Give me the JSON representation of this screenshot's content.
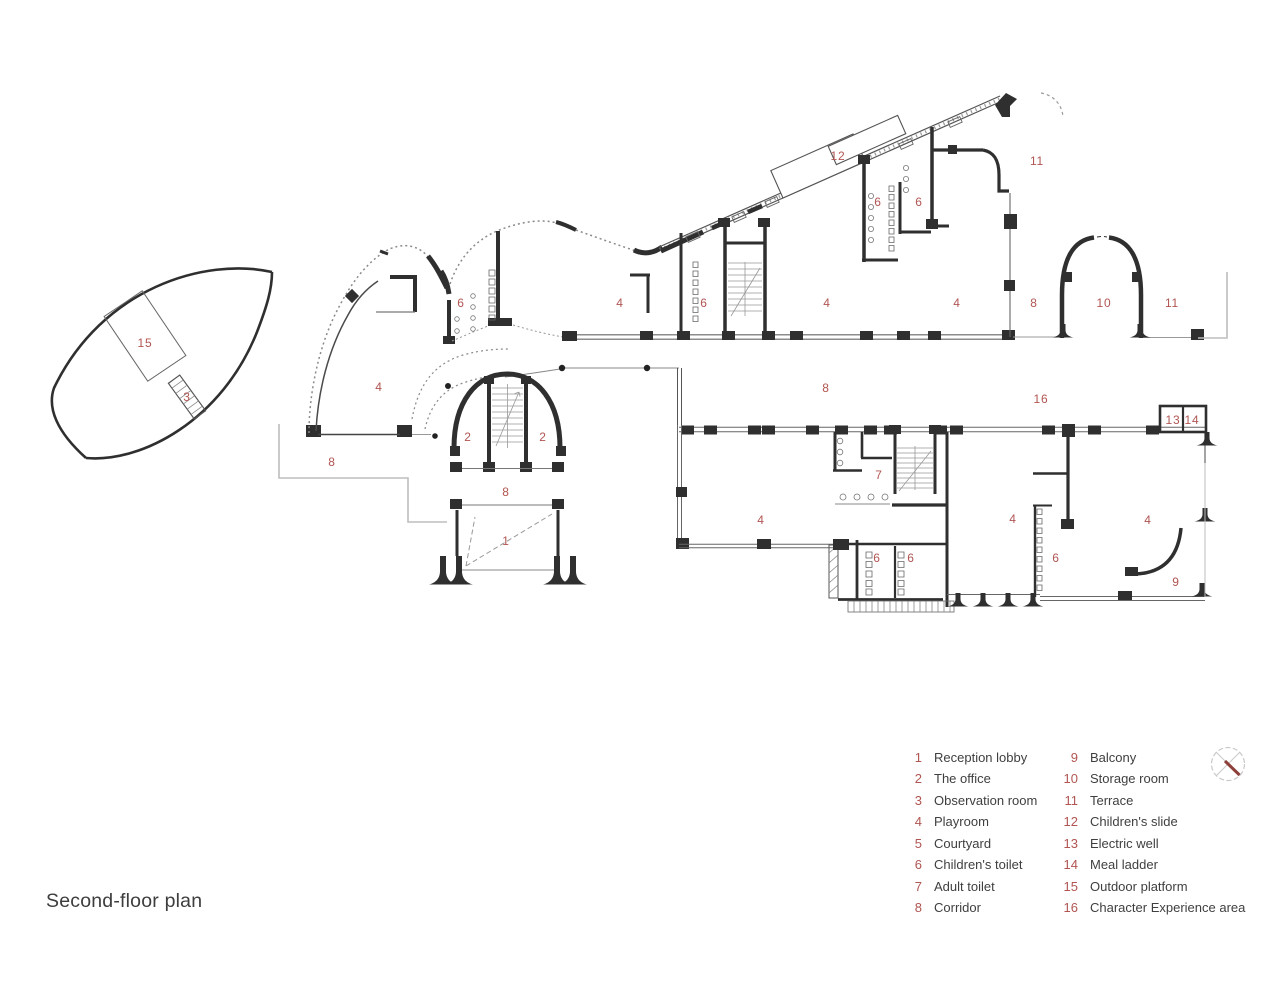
{
  "title": "Second-floor plan",
  "colors": {
    "red": "#b05552",
    "ink": "#2f2f2f",
    "gray": "#9a9a9a",
    "light": "#c9c9c9"
  },
  "compass": {
    "name": "north-compass"
  },
  "legend": {
    "items_left": [
      {
        "num": "1",
        "label": "Reception lobby"
      },
      {
        "num": "2",
        "label": "The office"
      },
      {
        "num": "3",
        "label": "Observation room"
      },
      {
        "num": "4",
        "label": "Playroom"
      },
      {
        "num": "5",
        "label": "Courtyard"
      },
      {
        "num": "6",
        "label": "Children's toilet"
      },
      {
        "num": "7",
        "label": "Adult toilet"
      },
      {
        "num": "8",
        "label": "Corridor"
      }
    ],
    "items_right": [
      {
        "num": "9",
        "label": "Balcony"
      },
      {
        "num": "10",
        "label": "Storage room"
      },
      {
        "num": "11",
        "label": "Terrace"
      },
      {
        "num": "12",
        "label": "Children's slide"
      },
      {
        "num": "13",
        "label": "Electric well"
      },
      {
        "num": "14",
        "label": "Meal ladder"
      },
      {
        "num": "15",
        "label": "Outdoor platform"
      },
      {
        "num": "16",
        "label": "Character Experience area"
      }
    ]
  },
  "plan_labels": [
    {
      "n": "15",
      "x": 145,
      "y": 343
    },
    {
      "n": "3",
      "x": 187,
      "y": 397
    },
    {
      "n": "8",
      "x": 332,
      "y": 462
    },
    {
      "n": "4",
      "x": 379,
      "y": 387
    },
    {
      "n": "6",
      "x": 461,
      "y": 303
    },
    {
      "n": "2",
      "x": 468,
      "y": 437
    },
    {
      "n": "2",
      "x": 543,
      "y": 437
    },
    {
      "n": "8",
      "x": 506,
      "y": 492
    },
    {
      "n": "1",
      "x": 506,
      "y": 541
    },
    {
      "n": "4",
      "x": 620,
      "y": 303
    },
    {
      "n": "6",
      "x": 704,
      "y": 303
    },
    {
      "n": "12",
      "x": 838,
      "y": 156
    },
    {
      "n": "6",
      "x": 878,
      "y": 202
    },
    {
      "n": "6",
      "x": 919,
      "y": 202
    },
    {
      "n": "4",
      "x": 827,
      "y": 303
    },
    {
      "n": "11",
      "x": 1037,
      "y": 161
    },
    {
      "n": "4",
      "x": 957,
      "y": 303
    },
    {
      "n": "8",
      "x": 1034,
      "y": 303
    },
    {
      "n": "10",
      "x": 1104,
      "y": 303
    },
    {
      "n": "11",
      "x": 1172,
      "y": 303
    },
    {
      "n": "8",
      "x": 826,
      "y": 388
    },
    {
      "n": "16",
      "x": 1041,
      "y": 399
    },
    {
      "n": "13",
      "x": 1173,
      "y": 420
    },
    {
      "n": "14",
      "x": 1192,
      "y": 420
    },
    {
      "n": "7",
      "x": 879,
      "y": 475
    },
    {
      "n": "4",
      "x": 761,
      "y": 520
    },
    {
      "n": "4",
      "x": 1013,
      "y": 519
    },
    {
      "n": "4",
      "x": 1148,
      "y": 520
    },
    {
      "n": "6",
      "x": 877,
      "y": 558
    },
    {
      "n": "6",
      "x": 911,
      "y": 558
    },
    {
      "n": "6",
      "x": 1056,
      "y": 558
    },
    {
      "n": "9",
      "x": 1176,
      "y": 582
    }
  ]
}
